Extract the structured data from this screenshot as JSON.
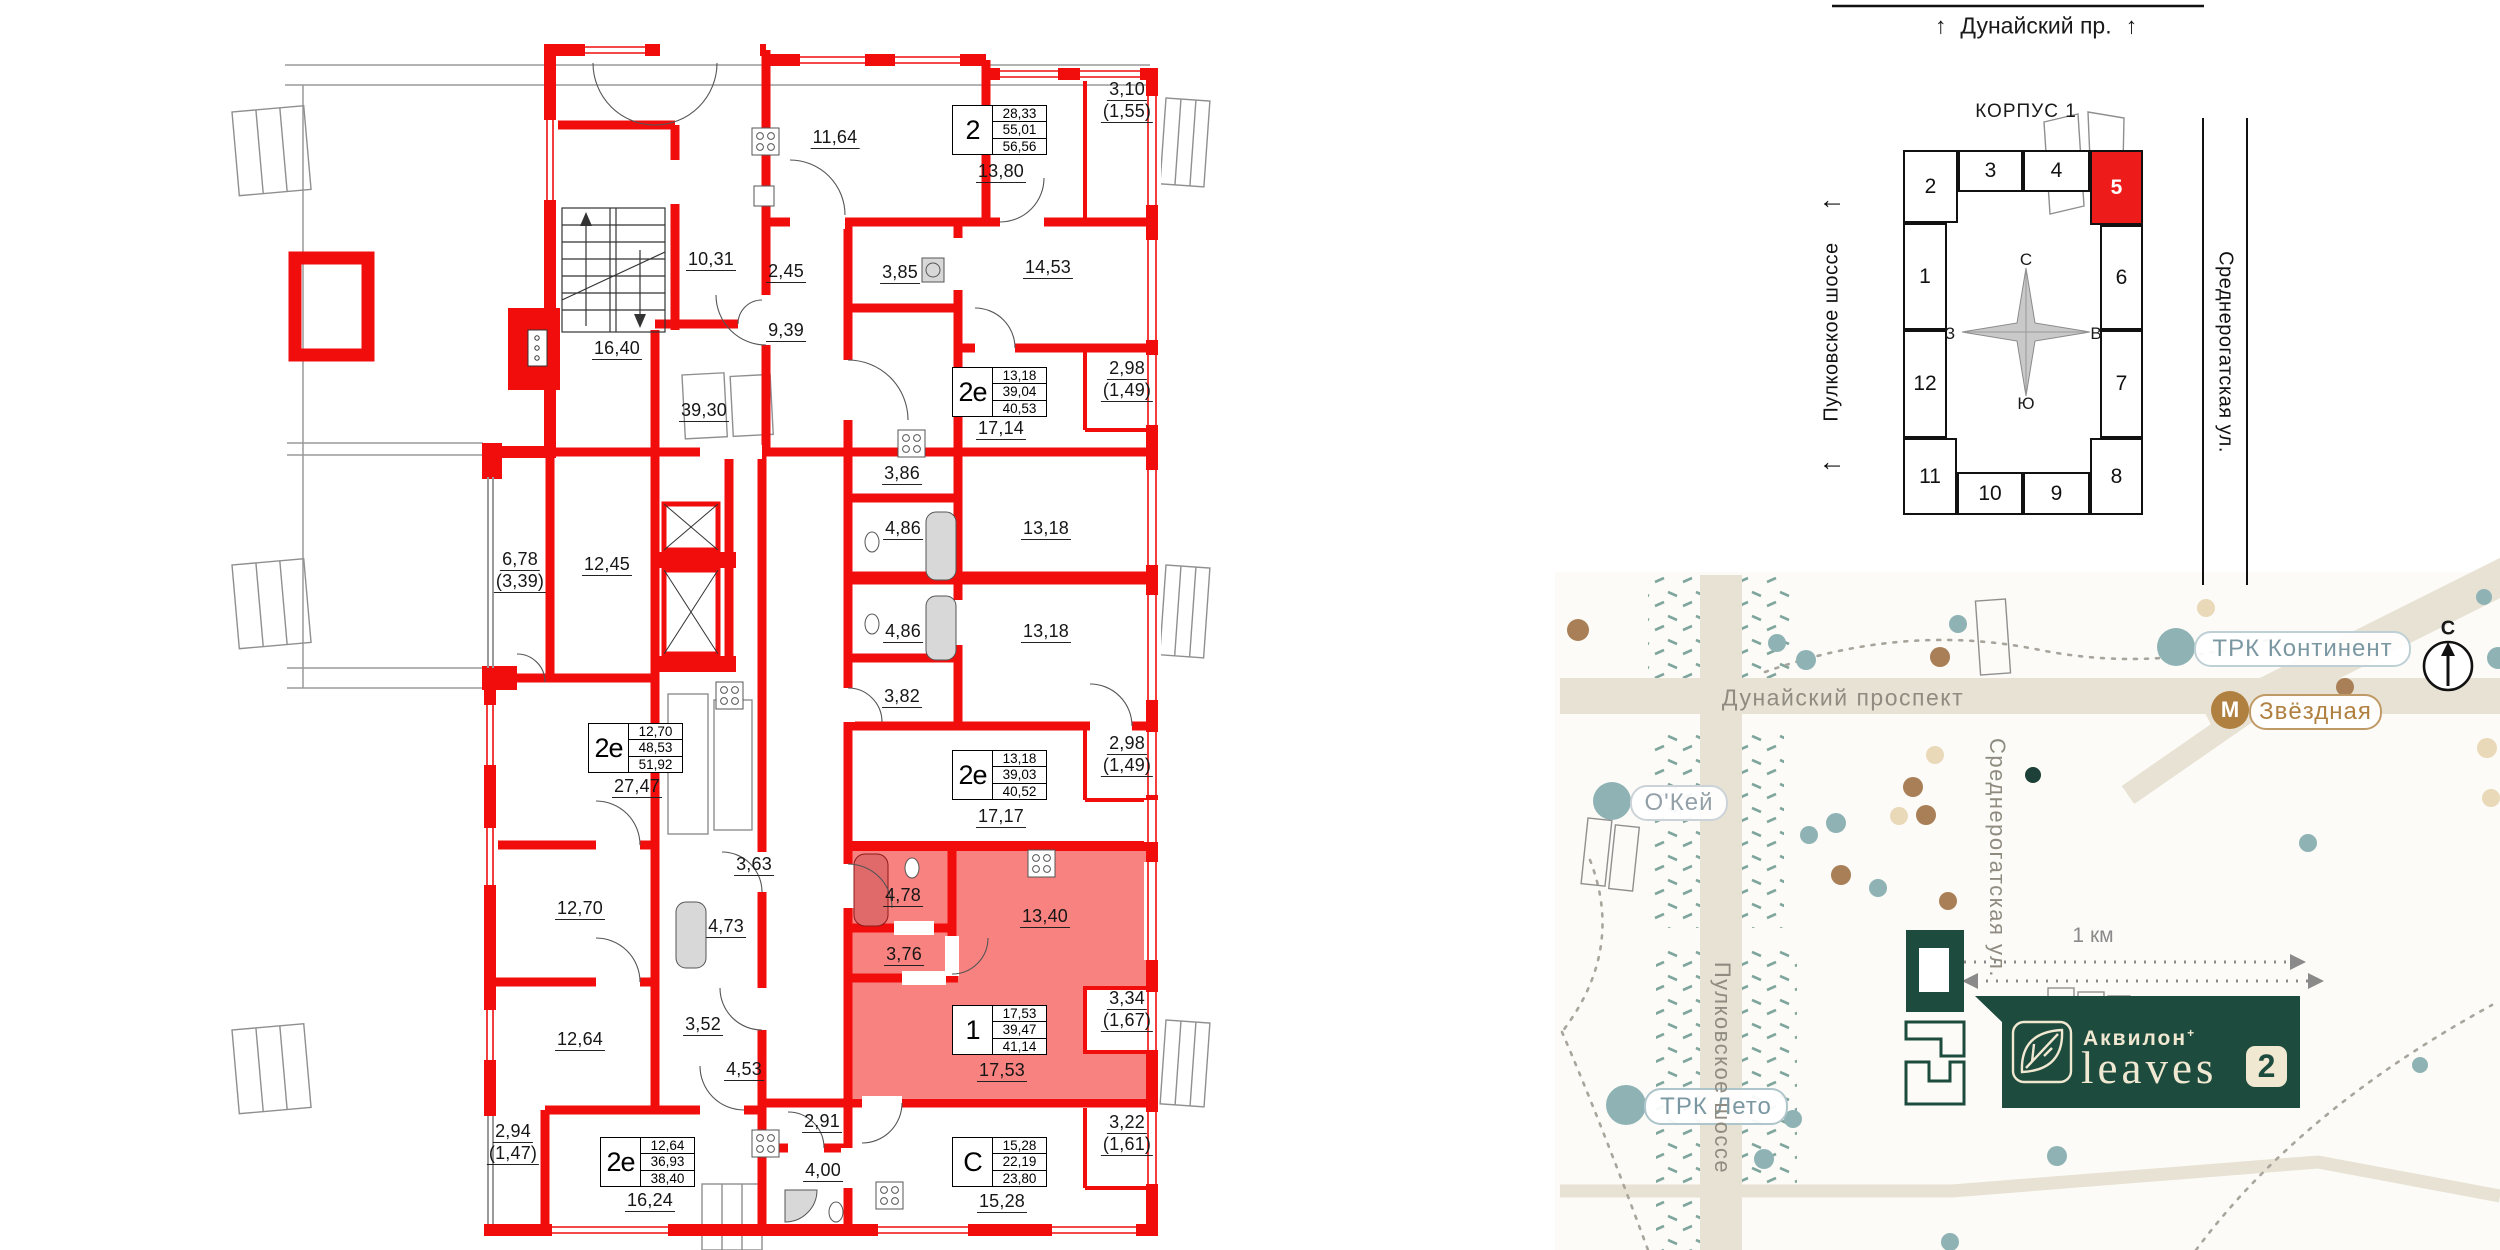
{
  "floorplan": {
    "wall_color": "#f20d0d",
    "highlight_color": "#f8827f",
    "labels": [
      {
        "l": [
          "11,64"
        ],
        "x": 835,
        "y": 127
      },
      {
        "l": [
          "13,80"
        ],
        "x": 1001,
        "y": 161
      },
      {
        "l": [
          "3,10",
          "(1,55)"
        ],
        "x": 1127,
        "y": 79
      },
      {
        "l": [
          "10,31"
        ],
        "x": 711,
        "y": 249
      },
      {
        "l": [
          "2,45"
        ],
        "x": 786,
        "y": 261
      },
      {
        "l": [
          "3,85"
        ],
        "x": 900,
        "y": 262
      },
      {
        "l": [
          "14,53"
        ],
        "x": 1048,
        "y": 257
      },
      {
        "l": [
          "16,40"
        ],
        "x": 617,
        "y": 338
      },
      {
        "l": [
          "9,39"
        ],
        "x": 786,
        "y": 320
      },
      {
        "l": [
          "39,30"
        ],
        "x": 704,
        "y": 400
      },
      {
        "l": [
          "17,14"
        ],
        "x": 1001,
        "y": 418
      },
      {
        "l": [
          "2,98",
          "(1,49)"
        ],
        "x": 1127,
        "y": 358
      },
      {
        "l": [
          "3,86"
        ],
        "x": 902,
        "y": 463
      },
      {
        "l": [
          "4,86"
        ],
        "x": 903,
        "y": 518
      },
      {
        "l": [
          "13,18"
        ],
        "x": 1046,
        "y": 518
      },
      {
        "l": [
          "4,86"
        ],
        "x": 903,
        "y": 621
      },
      {
        "l": [
          "13,18"
        ],
        "x": 1046,
        "y": 621
      },
      {
        "l": [
          "3,82"
        ],
        "x": 902,
        "y": 686
      },
      {
        "l": [
          "6,78",
          "(3,39)"
        ],
        "x": 520,
        "y": 549
      },
      {
        "l": [
          "12,45"
        ],
        "x": 607,
        "y": 554
      },
      {
        "l": [
          "27,47"
        ],
        "x": 637,
        "y": 776
      },
      {
        "l": [
          "17,17"
        ],
        "x": 1001,
        "y": 806
      },
      {
        "l": [
          "2,98",
          "(1,49)"
        ],
        "x": 1127,
        "y": 733
      },
      {
        "l": [
          "3,63"
        ],
        "x": 754,
        "y": 854
      },
      {
        "l": [
          "12,70"
        ],
        "x": 580,
        "y": 898
      },
      {
        "l": [
          "4,73"
        ],
        "x": 726,
        "y": 916
      },
      {
        "l": [
          "4,78"
        ],
        "x": 903,
        "y": 885
      },
      {
        "l": [
          "13,40"
        ],
        "x": 1045,
        "y": 906
      },
      {
        "l": [
          "3,76"
        ],
        "x": 904,
        "y": 944
      },
      {
        "l": [
          "3,52"
        ],
        "x": 703,
        "y": 1014
      },
      {
        "l": [
          "12,64"
        ],
        "x": 580,
        "y": 1029
      },
      {
        "l": [
          "4,53"
        ],
        "x": 744,
        "y": 1059
      },
      {
        "l": [
          "17,53"
        ],
        "x": 1002,
        "y": 1060
      },
      {
        "l": [
          "3,34",
          "(1,67)"
        ],
        "x": 1127,
        "y": 988
      },
      {
        "l": [
          "2,94",
          "(1,47)"
        ],
        "x": 513,
        "y": 1121
      },
      {
        "l": [
          "2,91"
        ],
        "x": 822,
        "y": 1111
      },
      {
        "l": [
          "4,00"
        ],
        "x": 823,
        "y": 1160
      },
      {
        "l": [
          "16,24"
        ],
        "x": 650,
        "y": 1190
      },
      {
        "l": [
          "15,28"
        ],
        "x": 1002,
        "y": 1191
      },
      {
        "l": [
          "3,22",
          "(1,61)"
        ],
        "x": 1127,
        "y": 1112
      }
    ],
    "apartments": [
      {
        "t": "2",
        "v": [
          "28,33",
          "55,01",
          "56,56"
        ],
        "x": 952,
        "y": 105
      },
      {
        "t": "2е",
        "v": [
          "13,18",
          "39,04",
          "40,53"
        ],
        "x": 952,
        "y": 367
      },
      {
        "t": "2е",
        "v": [
          "12,70",
          "48,53",
          "51,92"
        ],
        "x": 588,
        "y": 723
      },
      {
        "t": "2е",
        "v": [
          "13,18",
          "39,03",
          "40,52"
        ],
        "x": 952,
        "y": 750
      },
      {
        "t": "1",
        "v": [
          "17,53",
          "39,47",
          "41,14"
        ],
        "x": 952,
        "y": 1005
      },
      {
        "t": "2е",
        "v": [
          "12,64",
          "36,93",
          "38,40"
        ],
        "x": 600,
        "y": 1137
      },
      {
        "t": "С",
        "v": [
          "15,28",
          "22,19",
          "23,80"
        ],
        "x": 952,
        "y": 1137
      }
    ]
  },
  "korpus": {
    "title": "КОРПУС 1",
    "street_top": {
      "arrow": "↑",
      "name": "Дунайский пр."
    },
    "street_left": {
      "arrow": "←",
      "name": "Пулковское шоссе"
    },
    "street_right": {
      "name": "Среднерогатская ул."
    },
    "compass": {
      "n": "С",
      "e": "В",
      "s": "Ю",
      "w": "З"
    },
    "highlighted_cell": "5",
    "cells": [
      {
        "n": "2",
        "x": 1903,
        "y": 150,
        "w": 55,
        "h": 73
      },
      {
        "n": "3",
        "x": 1958,
        "y": 150,
        "w": 65,
        "h": 42
      },
      {
        "n": "4",
        "x": 2023,
        "y": 150,
        "w": 67,
        "h": 42
      },
      {
        "n": "5",
        "x": 2090,
        "y": 150,
        "w": 53,
        "h": 75,
        "red": true
      },
      {
        "n": "1",
        "x": 1903,
        "y": 223,
        "w": 44,
        "h": 107
      },
      {
        "n": "6",
        "x": 2100,
        "y": 225,
        "w": 43,
        "h": 105
      },
      {
        "n": "12",
        "x": 1903,
        "y": 330,
        "w": 44,
        "h": 108
      },
      {
        "n": "7",
        "x": 2100,
        "y": 330,
        "w": 43,
        "h": 108
      },
      {
        "n": "11",
        "x": 1903,
        "y": 438,
        "w": 54,
        "h": 77
      },
      {
        "n": "10",
        "x": 1957,
        "y": 472,
        "w": 66,
        "h": 43
      },
      {
        "n": "9",
        "x": 2023,
        "y": 472,
        "w": 67,
        "h": 43
      },
      {
        "n": "8",
        "x": 2090,
        "y": 438,
        "w": 53,
        "h": 77
      }
    ]
  },
  "map": {
    "roads": {
      "dunaysky": "Дунайский проспект",
      "pulkovskoe": "Пулковское шоссе",
      "srednerogatskaya": "Среднерогатская ул."
    },
    "scale_label": "1 км",
    "compass_n": "С",
    "logo": {
      "brand": "Аквилон",
      "plus": "+",
      "name": "leaves",
      "number": "2"
    },
    "pois": [
      {
        "label": "О'Кей",
        "cx": 1612,
        "cy": 801,
        "r": 19,
        "cc": "#8fb3b5",
        "x": 1630,
        "y": 785,
        "w": 94,
        "h": 32,
        "tc": "#93a0a8",
        "bc": "#ccd3d8"
      },
      {
        "label": "ТРК Континент",
        "cx": 2176,
        "cy": 647,
        "r": 19,
        "cc": "#8fb3b5",
        "x": 2194,
        "y": 631,
        "w": 213,
        "h": 32,
        "tc": "#7b98a2",
        "bc": "#bed0d6"
      },
      {
        "label": "Звёздная",
        "letter": "М",
        "cx": 2230,
        "cy": 710,
        "r": 19,
        "cc": "#b08040",
        "x": 2249,
        "y": 694,
        "w": 129,
        "h": 32,
        "tc": "#b08040",
        "bc": "#c09a66"
      },
      {
        "label": "ТРК Лето",
        "cx": 1626,
        "cy": 1105,
        "r": 20,
        "cc": "#8fb3b5",
        "x": 1644,
        "y": 1088,
        "w": 140,
        "h": 33,
        "tc": "#7b98a2",
        "bc": "#aec5cb"
      }
    ],
    "dots": [
      {
        "x": 1777,
        "y": 643,
        "r": 9,
        "c": "#8fb3b5"
      },
      {
        "x": 1806,
        "y": 660,
        "r": 10,
        "c": "#8fb3b5"
      },
      {
        "x": 1958,
        "y": 624,
        "r": 9,
        "c": "#8fb3b5"
      },
      {
        "x": 1836,
        "y": 823,
        "r": 10,
        "c": "#8fb3b5"
      },
      {
        "x": 1809,
        "y": 835,
        "r": 9,
        "c": "#8fb3b5"
      },
      {
        "x": 1878,
        "y": 888,
        "r": 9,
        "c": "#8fb3b5"
      },
      {
        "x": 2498,
        "y": 658,
        "r": 11,
        "c": "#8fb3b5"
      },
      {
        "x": 2484,
        "y": 597,
        "r": 8,
        "c": "#8fb3b5"
      },
      {
        "x": 2057,
        "y": 1156,
        "r": 10,
        "c": "#8fb3b5"
      },
      {
        "x": 1793,
        "y": 1119,
        "r": 9,
        "c": "#8fb3b5"
      },
      {
        "x": 1764,
        "y": 1159,
        "r": 10,
        "c": "#8fb3b5"
      },
      {
        "x": 2308,
        "y": 843,
        "r": 9,
        "c": "#8fb3b5"
      },
      {
        "x": 1950,
        "y": 1242,
        "r": 9,
        "c": "#8fb3b5"
      },
      {
        "x": 2420,
        "y": 1065,
        "r": 8,
        "c": "#8fb3b5"
      },
      {
        "x": 1578,
        "y": 630,
        "r": 11,
        "c": "#a97f57"
      },
      {
        "x": 1940,
        "y": 657,
        "r": 10,
        "c": "#a97f57"
      },
      {
        "x": 1913,
        "y": 787,
        "r": 10,
        "c": "#a97f57"
      },
      {
        "x": 1926,
        "y": 815,
        "r": 10,
        "c": "#a97f57"
      },
      {
        "x": 1841,
        "y": 875,
        "r": 10,
        "c": "#a97f57"
      },
      {
        "x": 1948,
        "y": 901,
        "r": 9,
        "c": "#a97f57"
      },
      {
        "x": 2345,
        "y": 687,
        "r": 9,
        "c": "#a97f57"
      },
      {
        "x": 1935,
        "y": 755,
        "r": 9,
        "c": "#ead9b9"
      },
      {
        "x": 1899,
        "y": 816,
        "r": 9,
        "c": "#ead9b9"
      },
      {
        "x": 2206,
        "y": 608,
        "r": 9,
        "c": "#ead9b9"
      },
      {
        "x": 2487,
        "y": 748,
        "r": 10,
        "c": "#ead9b9"
      },
      {
        "x": 2491,
        "y": 798,
        "r": 9,
        "c": "#ead9b9"
      },
      {
        "x": 2033,
        "y": 775,
        "r": 8,
        "c": "#1d4038"
      }
    ]
  }
}
